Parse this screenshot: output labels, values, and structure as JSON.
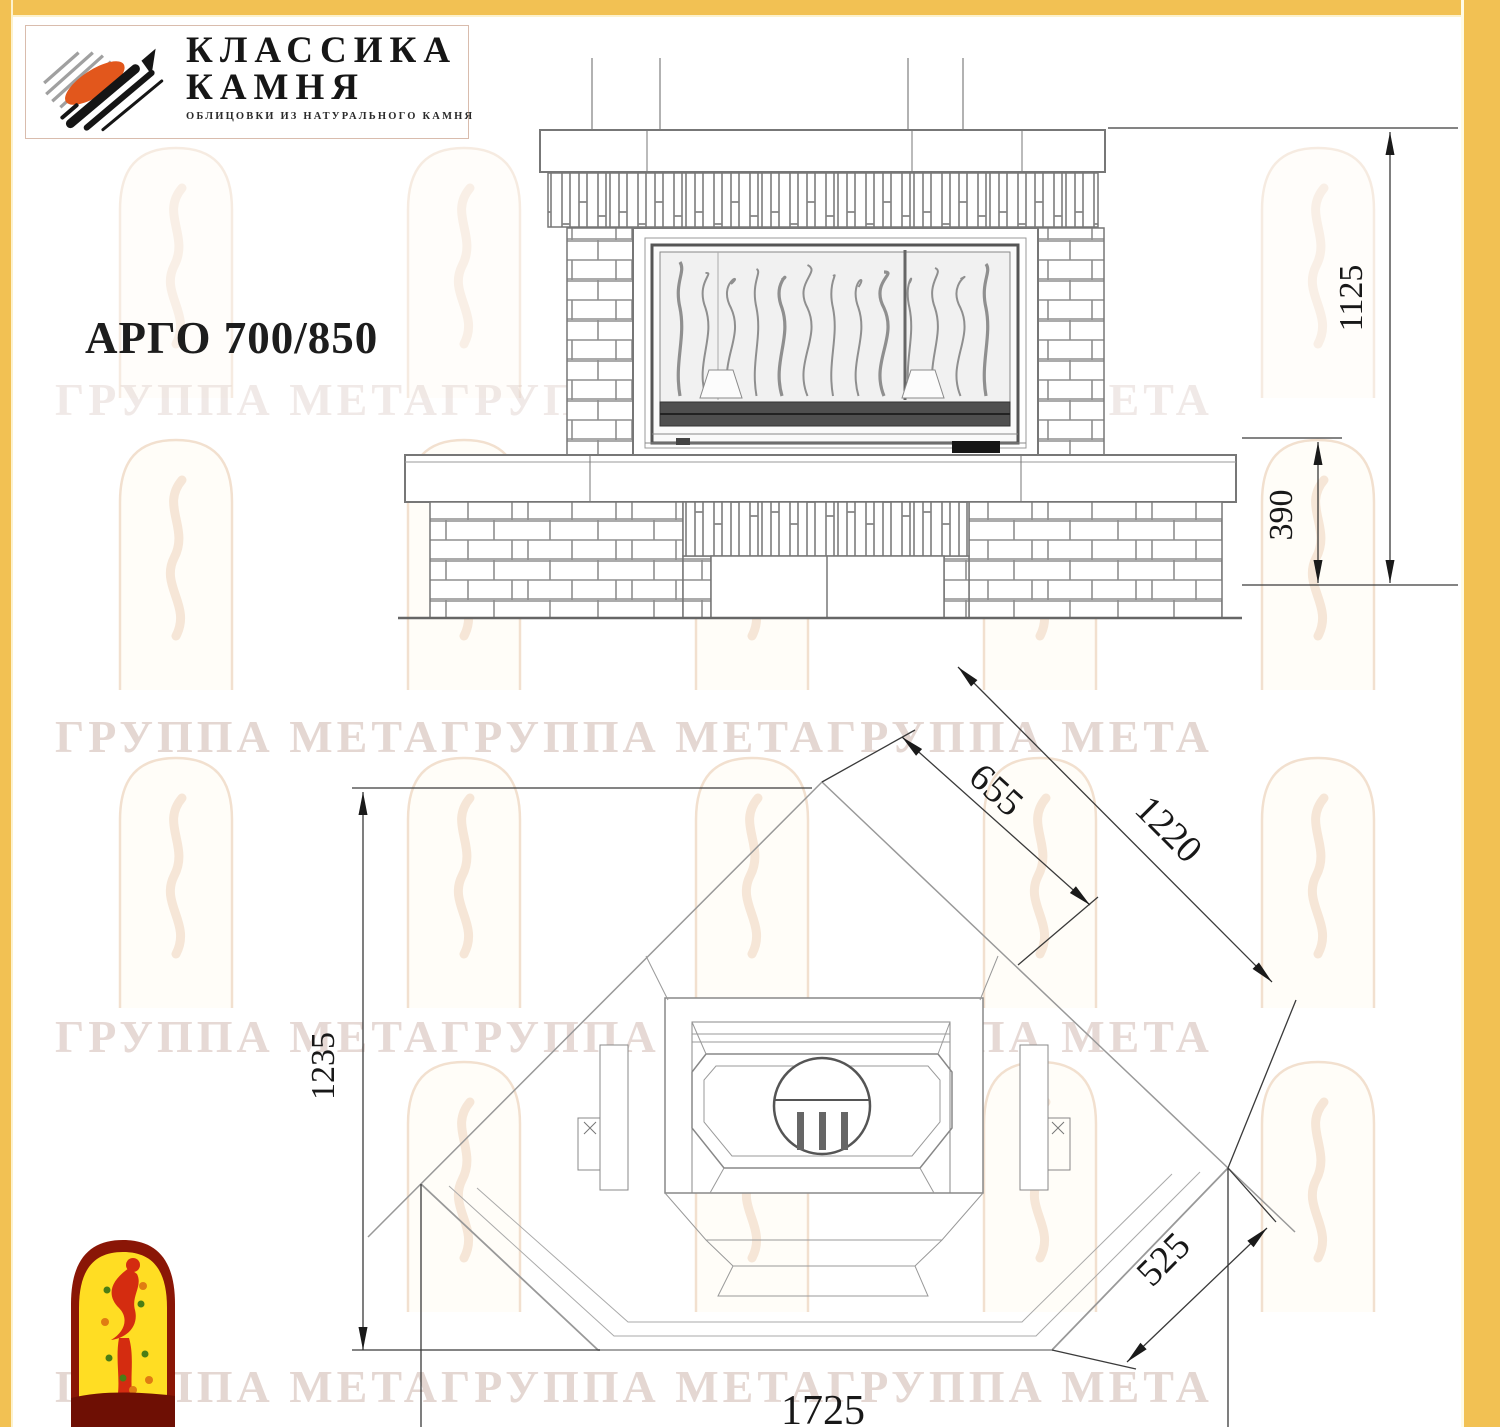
{
  "page": {
    "background": "#ffffff",
    "border_color": "#f2c153"
  },
  "header_logo": {
    "line1": "КЛАССИКА",
    "line2": "КАМНЯ",
    "subtitle": "ОБЛИЦОВКИ ИЗ НАТУРАЛЬНОГО КАМНЯ"
  },
  "title": "АРГО 700/850",
  "watermark": {
    "text": "ГРУППА МЕТАГРУППА МЕТАГРУППА МЕТА"
  },
  "views": {
    "front_elevation": "front view of fireplace",
    "plan_view": "corner installation plan"
  },
  "dimensions": {
    "front_total_height": "1125",
    "base_height": "390",
    "firebox_diagonal": "655",
    "wall_diagonal": "1220",
    "plan_depth": "1235",
    "front_corner_edge": "525",
    "plan_total_width": "1725"
  },
  "colors": {
    "accent_yellow": "#f2c153",
    "logo_orange": "#e2571c",
    "logo_black": "#151515",
    "footer_maroon": "#8a1606",
    "footer_yellow": "#ffdd23",
    "footer_red": "#d42c10",
    "drawing_line_gray": "#7a7a7a"
  }
}
